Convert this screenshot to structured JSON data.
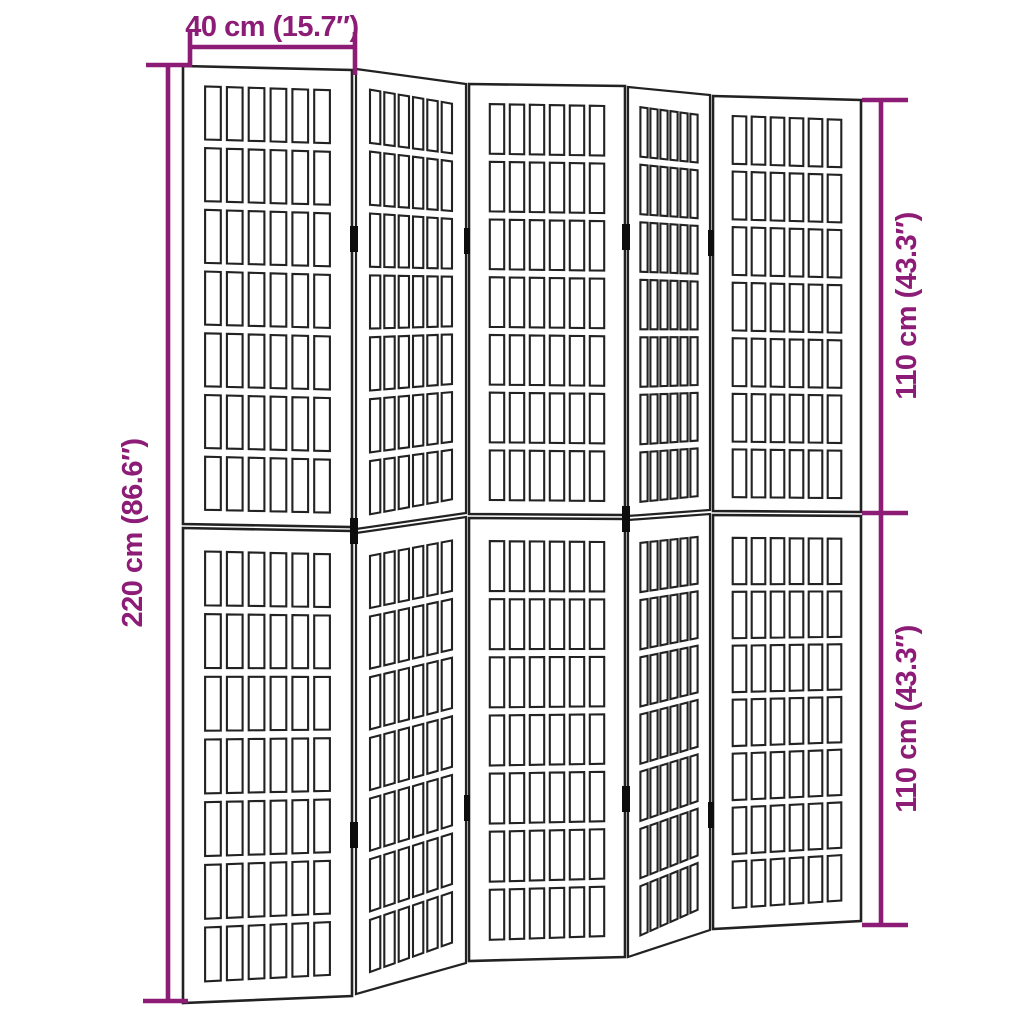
{
  "diagram": {
    "background": "#ffffff",
    "colors": {
      "dimension": "#8d1c77",
      "line": "#222222",
      "hinge": "#0d0d0d"
    },
    "dimensions": {
      "panel_width": "40 cm (15.7″)",
      "total_height": "220 cm (86.6″)",
      "upper_section_height": "110 cm (43.3″)",
      "lower_section_height": "110 cm (43.3″)"
    },
    "screen": {
      "panel_count": 5,
      "sections_per_panel": 2,
      "grid_columns": 6,
      "grid_rows_per_section": 7,
      "hinge_count": 10
    }
  }
}
